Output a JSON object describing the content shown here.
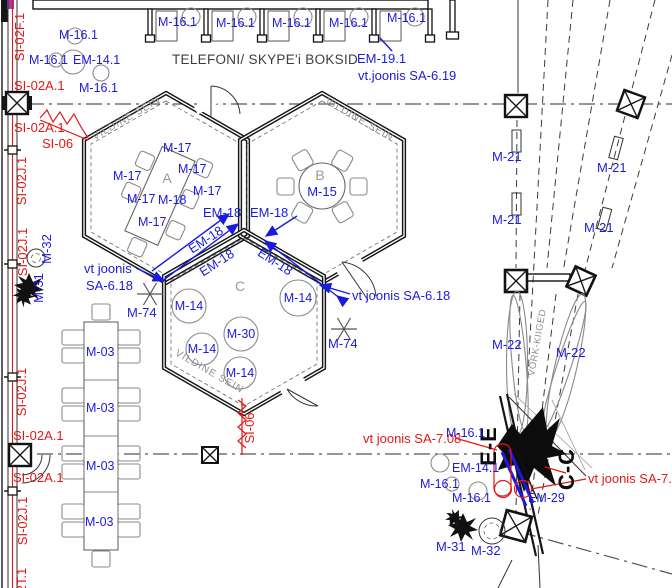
{
  "colors": {
    "annotation_blue": "#1b1be0",
    "annotation_red": "#e51717",
    "wall_black": "#161616",
    "furniture_gray": "#8a8a8a",
    "grid_gray": "#555555",
    "purple_marker": "#a23ba2"
  },
  "booth_area": {
    "title": "TELEFONI/ SKYPE'i BOKSID",
    "unit_label": "M-16.1",
    "em_label": "EM-14.1",
    "em19_label": "EM-19.1",
    "em19_ref": "vt.joonis SA-6.19"
  },
  "rooms": {
    "a": {
      "letter": "A",
      "wall_text": "VILDINE SEIN",
      "chair_label": "M-17",
      "table_label": "M-18"
    },
    "b": {
      "letter": "B",
      "wall_text": "VILDINE SEIN",
      "table_label": "M-15"
    },
    "c": {
      "letter": "C",
      "wall_text": "VILDINE SEIN",
      "pouf_label": "M-14",
      "table_label": "M-30"
    }
  },
  "curtains": {
    "em18_label": "EM-18",
    "ref_left_line1": "vt joonis",
    "ref_left_line2": "SA-6.18",
    "ref_right": "vt joonis SA-6.18",
    "star_label": "M-74"
  },
  "left_zone": {
    "table_label": "M-03",
    "plant_label": "M-31",
    "pot_label": "M-32"
  },
  "right_zone": {
    "light_label": "M-21",
    "swing_label": "M-22",
    "swing_area_text": "VÕRK-KIIGED"
  },
  "bottom_right": {
    "section_ee": "E-E",
    "section_cc": "C-C",
    "booth_label": "M-16.1",
    "em14_label": "EM-14.1",
    "em29_label": "EM-29",
    "plant_label": "M-31",
    "pot_label": "M-32",
    "ref_sa708": "vt joonis SA-7.08"
  },
  "wall_codes": {
    "si02f": "SI-02F.1",
    "si02a": "SI-02A.1",
    "si06": "SI-06",
    "si02j": "SI-02J.1",
    "si02t": "SI-02T.1"
  }
}
